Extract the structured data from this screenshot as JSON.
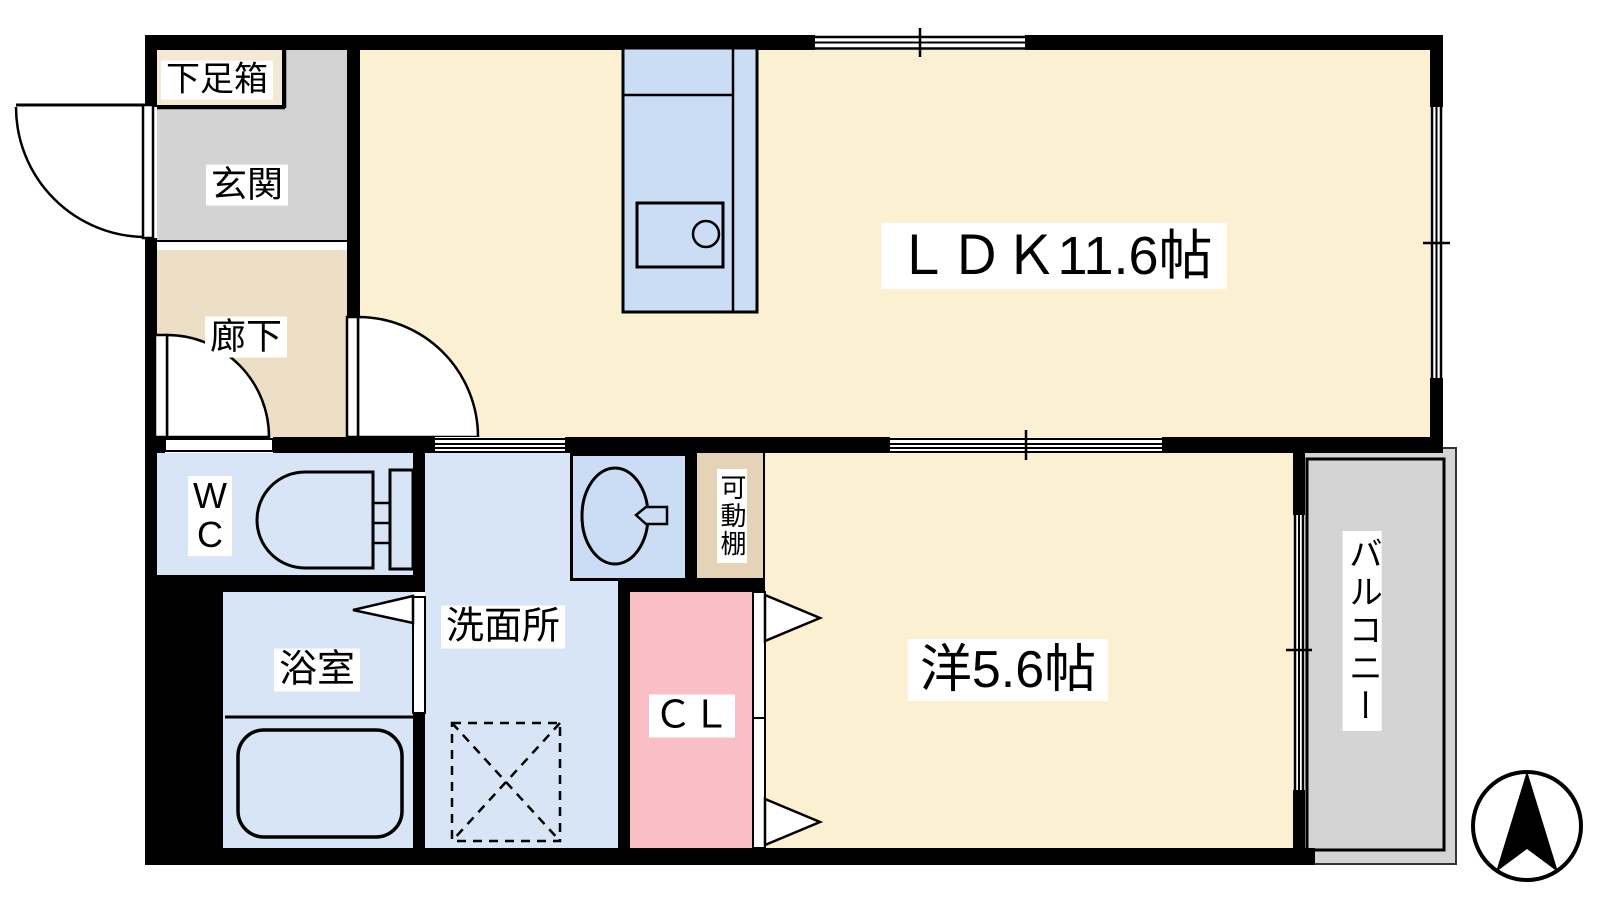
{
  "floorplan": {
    "type": "japanese-apartment-floor-plan",
    "rooms": {
      "shoe_box": {
        "label": "下足箱"
      },
      "genkan": {
        "label": "玄関"
      },
      "corridor": {
        "label": "廊下"
      },
      "ldk": {
        "label": "ＬＤＫ11.6帖"
      },
      "wc": {
        "label": "W\nC"
      },
      "washroom": {
        "label": "洗面所"
      },
      "movable_shelf": {
        "label": "可動棚"
      },
      "bath": {
        "label": "浴室"
      },
      "closet": {
        "label": "ＣＬ"
      },
      "western_room": {
        "label": "洋5.6帖"
      },
      "balcony": {
        "label": "バルコニー"
      }
    },
    "compass": {
      "direction": "north-up",
      "style": "black-arrow-in-circle"
    },
    "colors": {
      "floor_main": "#FCF0D2",
      "genkan_gray": "#D3D3D3",
      "corridor_tan": "#ECDFC5",
      "shoe_box_tan": "#F3E9D5",
      "wet_area_blue": "#D8E5F7",
      "fixture_blue": "#CBDDF4",
      "closet_pink": "#F9BFC4",
      "shelf_tan": "#E4D3B6",
      "balcony_gray": "#D4D4D4",
      "wall_black": "#000000"
    }
  }
}
